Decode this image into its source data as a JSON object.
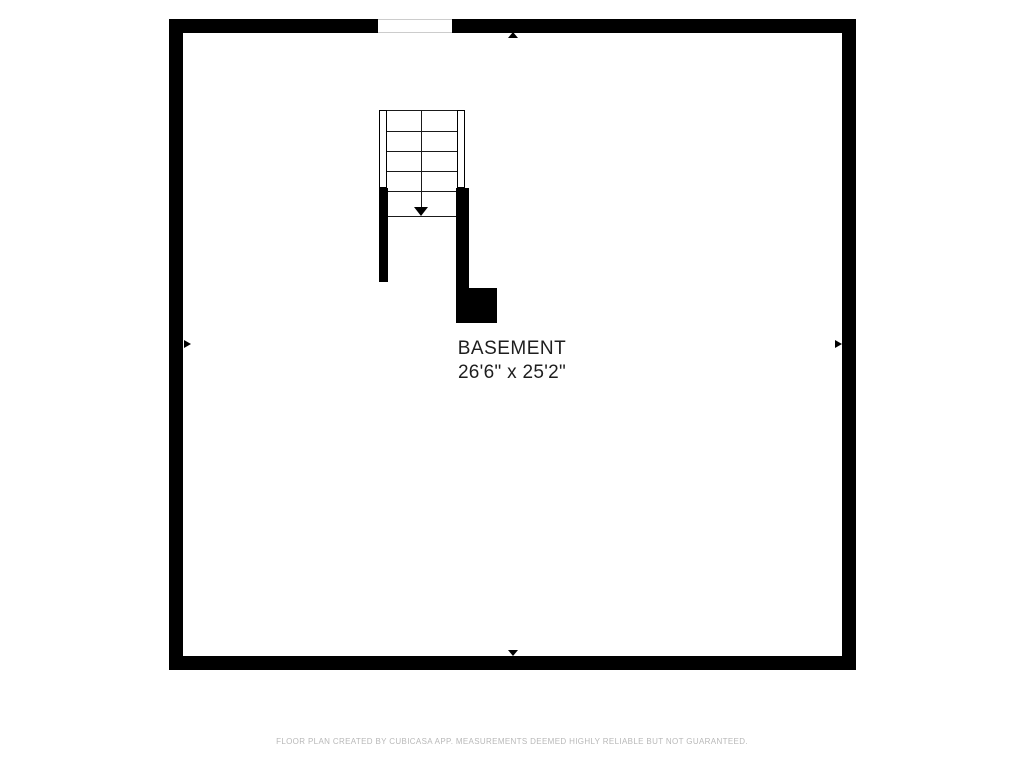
{
  "floor_plan": {
    "room": {
      "label": "BASEMENT",
      "dimensions": "26'6\" x 25'2\""
    },
    "stairs": {
      "direction_icon": "down-arrow-icon",
      "tread_count": 5
    },
    "wall_markers": [
      "triangle-up-icon",
      "triangle-right-icon",
      "triangle-down-icon",
      "triangle-right-icon"
    ],
    "footer": "FLOOR PLAN CREATED BY CUBICASA APP. MEASUREMENTS DEEMED HIGHLY RELIABLE BUT NOT GUARANTEED.",
    "colors": {
      "wall": "#000000",
      "room_text": "#1e1e1e",
      "footer_text": "#b8b8b8",
      "background": "#ffffff",
      "opening_outline": "#cccccc"
    }
  }
}
